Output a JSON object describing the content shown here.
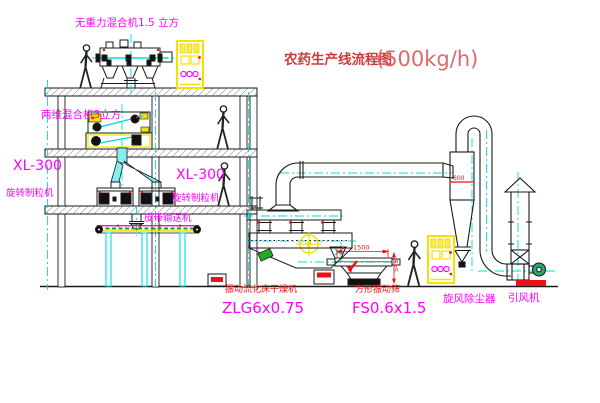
{
  "title": {
    "main": "农药生产线流程图",
    "capacity": "(500kg/h)"
  },
  "labels": {
    "top_mixer": "无重力混合机1.5 立方",
    "mid_mixer": "两维混合机3立方",
    "granulator_left_model": "XL-300",
    "granulator_left_name": "旋转制粒机",
    "granulator_mid_model": "XL-300",
    "granulator_mid_name": "旋转制粒机",
    "belt_conveyor": "皮带输送机",
    "dryer_name": "振动流化床干燥机",
    "dryer_model": "ZLG6x0.75",
    "sieve_name": "方形振动筛",
    "sieve_model": "FS0.6x1.5",
    "cyclone": "旋风除尘器",
    "fan": "引风机"
  },
  "dimensions": {
    "sieve_length": "1500",
    "sieve_height": "545",
    "cyclone_diameter": "600"
  },
  "colors": {
    "line_black": "#1a1a1a",
    "centerline_cyan": "#00dede",
    "label_magenta": "#ff00ff",
    "annotation_red": "#ee1111",
    "equipment_yellow": "#f2e200",
    "title_red": "#cf3a3a",
    "capacity_red": "#e06868",
    "belt_green": "#00aa00",
    "motor_green": "#2aa870",
    "chute_cyan": "#86eeee"
  }
}
